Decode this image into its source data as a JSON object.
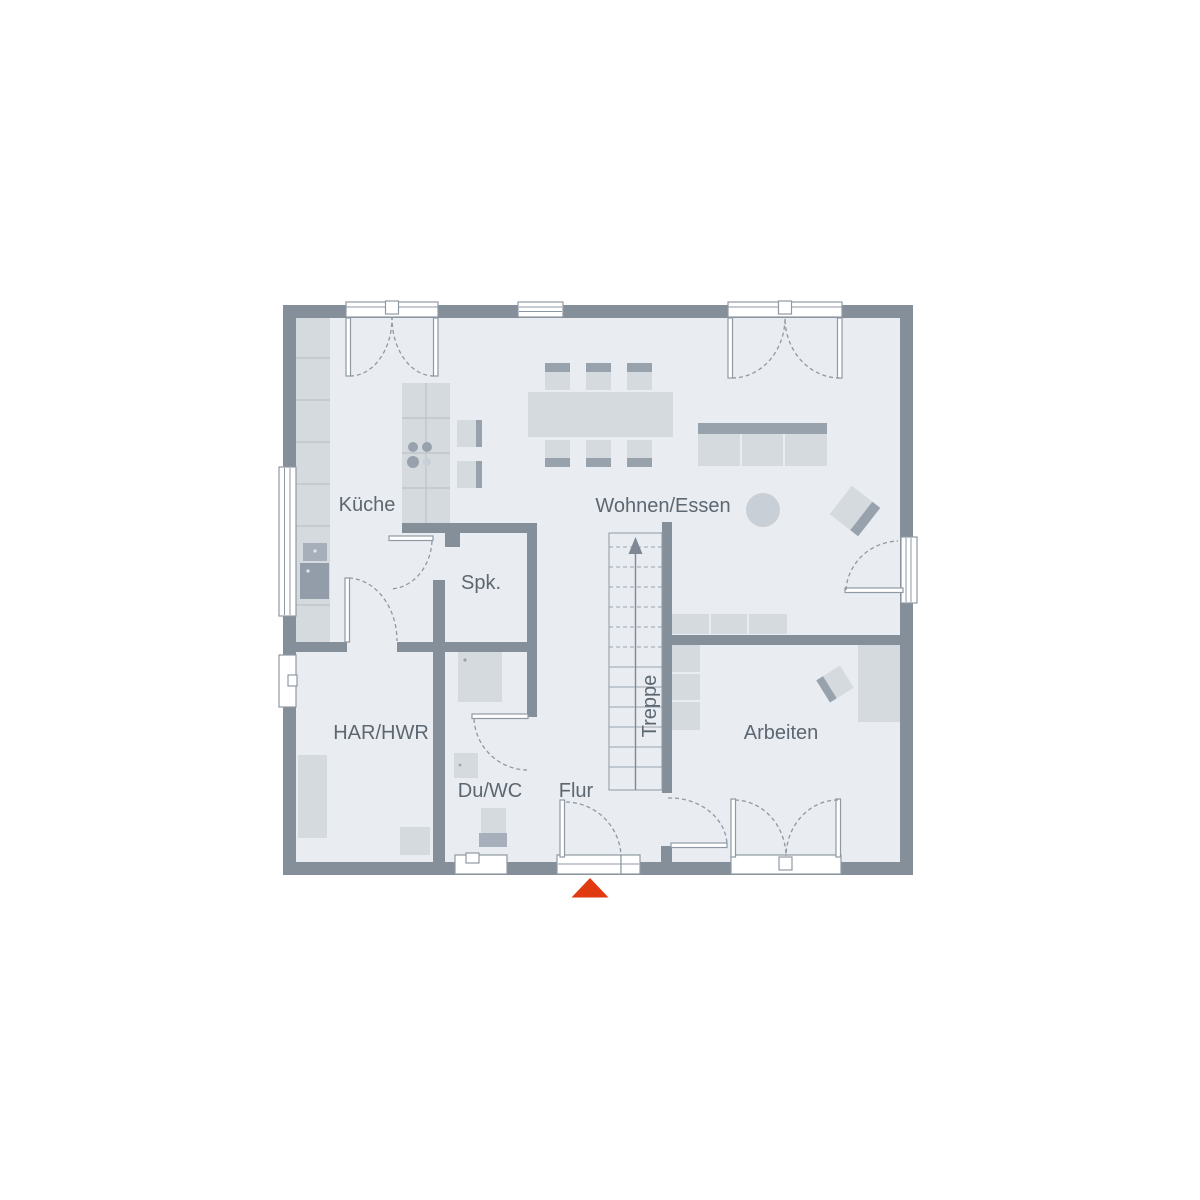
{
  "document": {
    "type": "floor-plan",
    "floor": "ground-floor"
  },
  "rooms": {
    "kueche": "Küche",
    "wohnen_essen": "Wohnen/Essen",
    "spk": "Spk.",
    "har_hwr": "HAR/HWR",
    "du_wc": "Du/WC",
    "flur": "Flur",
    "treppe": "Treppe",
    "arbeiten": "Arbeiten"
  },
  "icons": {
    "entrance_marker": "red-triangle-up",
    "stairs_direction": "arrow-up"
  },
  "colors": {
    "wall": "#858f9a",
    "floor": "#e9ecf0",
    "furniture": "#d5dade",
    "furniture_medium": "#c9cfd6",
    "furniture_dark": "#98a2ac",
    "appliance": "#a7b0ba",
    "outline": "#8f99a4",
    "label_text": "#5d6771",
    "accent_red": "#e23a10",
    "background": "#ffffff"
  }
}
